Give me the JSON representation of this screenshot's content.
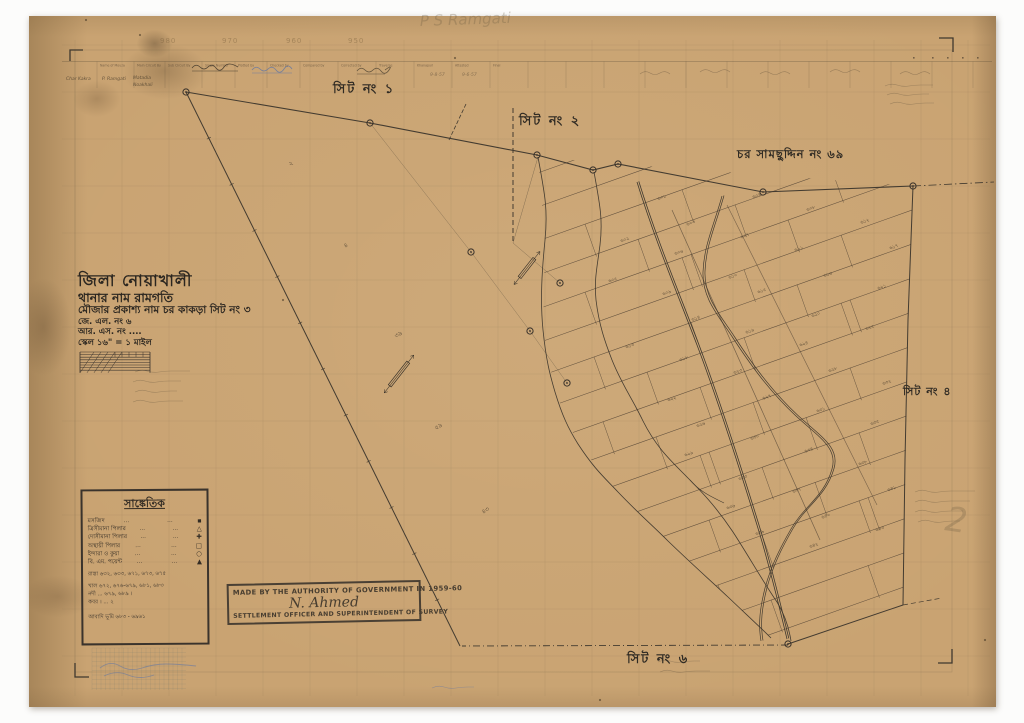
{
  "colors": {
    "paper": "#c9a372",
    "ink": "#2f2a23",
    "line": "#433b30",
    "pencil": "#6f6049",
    "blue": "#5d74a8",
    "stamp": "#4a4034"
  },
  "sheet_labels": {
    "sheet1": "সিট নং ১",
    "sheet2": "সিট নং ২",
    "sheet4": "সিট নং ৪",
    "sheet6": "সিট নং ৬",
    "char_name": "চর সামছুদ্দিন নং ৬৯"
  },
  "title_block": {
    "district": "জিলা নোয়াখালী",
    "thana": "থানার নাম রামগতি",
    "mouza": "মৌজার প্রকাশ্য নাম চর কাকড়া সিট নং ৩",
    "jl_no": "জে. এল. নং ৬",
    "rs_no": "আর. এস. নং ....",
    "scale": "স্কেল ১৬\" = ১ মাইল"
  },
  "legend": {
    "title": "সাঙ্কেতিক",
    "rows": [
      {
        "label": "মসজিদ",
        "leader": "...",
        "leader2": "...",
        "symbol": "▪"
      },
      {
        "label": "ত্রিসীমানা পিলার",
        "leader": "...",
        "leader2": "...",
        "symbol": "△"
      },
      {
        "label": "দোসীমানা পিলার",
        "leader": "...",
        "leader2": "...",
        "symbol": "✚"
      },
      {
        "label": "অস্থায়ী পিলার",
        "leader": "...",
        "leader2": "...",
        "symbol": "□"
      },
      {
        "label": "ইন্দারা ও কুয়া",
        "leader": "...",
        "leader2": "...",
        "symbol": "○"
      },
      {
        "label": "বি. এম. পয়েন্ট",
        "leader": "...",
        "leader2": "...",
        "symbol": "▲"
      }
    ],
    "notes": [
      "রাস্তা ৬৩২, ৬৩৩, ৬৭১, ৬৭৩, ৬৭৫",
      "খাল ৬৭২, ৬৭৬-৬৭৯, ৬৮১, ৬৮৩",
      "নদী ... ৬৭৯, ৬৮৯ ।",
      "কবর । ... ২",
      "আবাদি ভূমি ৬৮৩ - ৬৯৬১"
    ]
  },
  "stamp": {
    "line1": "MADE BY THE AUTHORITY OF GOVERNMENT IN 1959-60",
    "signature": "N. Ahmed",
    "line2": "SETTLEMENT OFFICER AND SUPERINTENDENT OF SURVEY"
  },
  "top_table": {
    "headers": [
      "Name of Mouza",
      "Main Circuit By",
      "Sub Circuit By",
      "Single Number",
      "Plotted by",
      "Checked by",
      "Compared by",
      "Corrected by",
      "Traverse",
      "Khanapuri",
      "Attested",
      "Final"
    ],
    "entries": [
      {
        "text": "Char Kakra",
        "x": 66,
        "y": 74
      },
      {
        "text": "P. Ramgati",
        "x": 102,
        "y": 74
      },
      {
        "text": "Matadia",
        "x": 133,
        "y": 73
      },
      {
        "text": "Noakhali",
        "x": 133,
        "y": 80
      }
    ],
    "dates": [
      {
        "text": "9-8-57",
        "x": 430,
        "y": 70
      },
      {
        "text": "9-6-57",
        "x": 462,
        "y": 70
      }
    ],
    "coord_numbers": [
      {
        "text": "980",
        "x": 160,
        "y": 36
      },
      {
        "text": "970",
        "x": 222,
        "y": 36
      },
      {
        "text": "960",
        "x": 286,
        "y": 36
      },
      {
        "text": "950",
        "x": 348,
        "y": 36
      }
    ],
    "pencil_script": "P S Ramgati"
  },
  "middle_marks": [
    {
      "t": "২",
      "x": 290,
      "y": 166
    },
    {
      "t": "৪",
      "x": 345,
      "y": 248
    },
    {
      "t": "৩৯",
      "x": 396,
      "y": 338
    },
    {
      "t": "৫৯",
      "x": 436,
      "y": 430
    },
    {
      "t": "৪৩",
      "x": 483,
      "y": 514
    }
  ],
  "big_pencil_mark": {
    "t": "2",
    "x": 944,
    "y": 530
  },
  "plot_numbers": [
    601,
    602,
    603,
    604,
    605,
    606,
    607,
    608,
    609,
    610,
    611,
    612,
    613,
    614,
    615,
    616,
    617,
    618,
    619,
    620,
    621,
    622,
    623,
    624,
    625,
    626,
    627,
    628,
    629,
    630,
    631,
    632,
    633,
    634,
    635,
    636,
    637,
    638,
    639,
    640,
    641,
    642,
    643,
    644,
    645,
    646,
    647,
    648
  ]
}
